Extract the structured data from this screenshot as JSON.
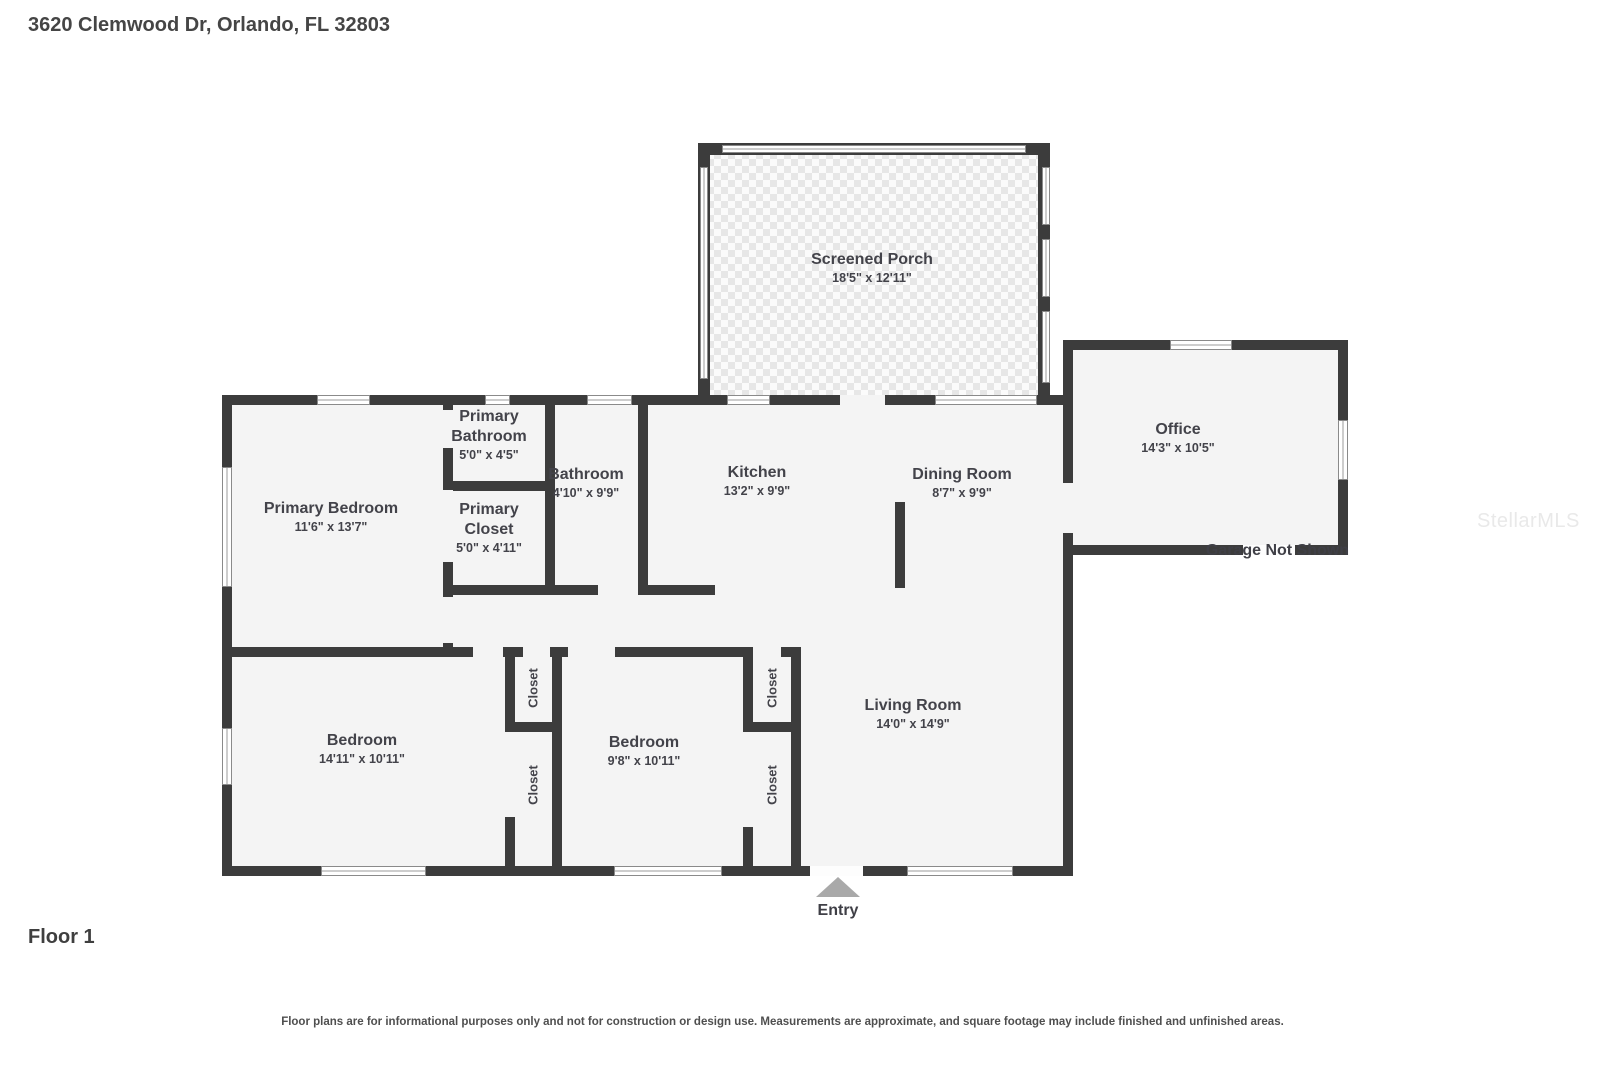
{
  "page": {
    "title": "3620 Clemwood Dr, Orlando, FL 32803",
    "floor_label": "Floor 1",
    "disclaimer": "Floor plans are for informational purposes only and not for construction or design use. Measurements are approximate, and square footage may include finished and unfinished areas.",
    "watermark": "StellarMLS"
  },
  "annotations": {
    "entry": "Entry",
    "garage_note": "Garage Not Shown"
  },
  "rooms": [
    {
      "id": "screened-porch",
      "name": "Screened Porch",
      "dims": "18'5\" x 12'11\""
    },
    {
      "id": "office",
      "name": "Office",
      "dims": "14'3\" x 10'5\""
    },
    {
      "id": "primary-bedroom",
      "name": "Primary Bedroom",
      "dims": "11'6\" x 13'7\""
    },
    {
      "id": "primary-bathroom",
      "name": "Primary Bathroom",
      "dims": "5'0\" x 4'5\""
    },
    {
      "id": "primary-closet",
      "name": "Primary Closet",
      "dims": "5'0\" x 4'11\""
    },
    {
      "id": "bathroom",
      "name": "Bathroom",
      "dims": "4'10\" x 9'9\""
    },
    {
      "id": "kitchen",
      "name": "Kitchen",
      "dims": "13'2\" x 9'9\""
    },
    {
      "id": "dining-room",
      "name": "Dining Room",
      "dims": "8'7\" x 9'9\""
    },
    {
      "id": "bedroom-1",
      "name": "Bedroom",
      "dims": "14'11\" x 10'11\""
    },
    {
      "id": "bedroom-2",
      "name": "Bedroom",
      "dims": "9'8\" x 10'11\""
    },
    {
      "id": "living-room",
      "name": "Living Room",
      "dims": "14'0\" x 14'9\""
    }
  ],
  "closets": [
    "Closet",
    "Closet",
    "Closet",
    "Closet"
  ],
  "colors": {
    "wall": "#3c3c3c",
    "room_fill": "#f4f4f4",
    "text": "#43434a",
    "entry_arrow": "#a9a9a9"
  }
}
